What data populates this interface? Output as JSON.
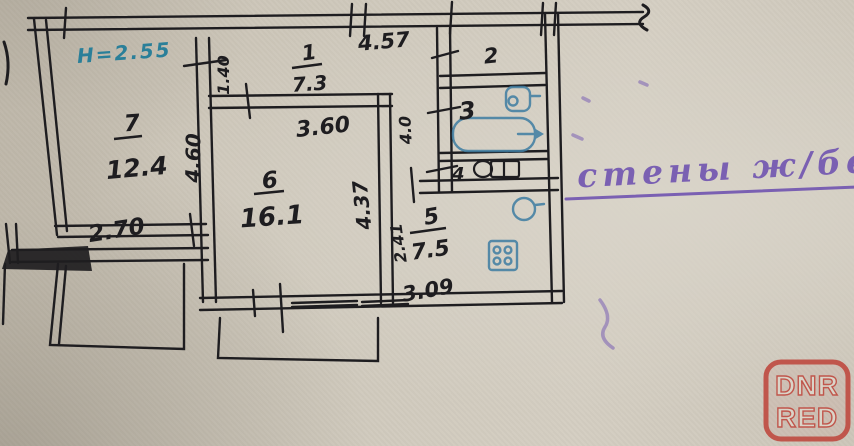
{
  "notes": {
    "ceiling_height": "Н=2.55",
    "wall_material": "стены ж/бет."
  },
  "rooms": {
    "r7": {
      "num": "7",
      "area": "12.4"
    },
    "r1": {
      "num": "1",
      "area": "7.3"
    },
    "r6": {
      "num": "6",
      "area": "16.1"
    },
    "r5": {
      "num": "5",
      "area": "7.5"
    },
    "r2": {
      "num": "2"
    },
    "r3": {
      "num": "3"
    },
    "r4": {
      "num": "4"
    }
  },
  "dims": {
    "top_wall": "4.57",
    "room7_width": "2.70",
    "room7_height": "4.60",
    "hall_height": "1.40",
    "room6_width": "3.60",
    "room6_height": "4.37",
    "corridor_length": "4.0",
    "kitchen_height": "2.41",
    "kitchen_width": "3.09"
  },
  "fixtures": {
    "bathtub": "bathtub",
    "bath_sink": "bath-sink",
    "kitchen_sink": "kitchen-sink",
    "stove": "stove",
    "toilet": "toilet"
  },
  "logo": {
    "line1": "DNR",
    "line2": "RED"
  },
  "colors": {
    "paper": "#cfc9bc",
    "ink": "#1e1d20",
    "fixture_blue": "#3e7da2",
    "note_teal": "#2a7f99",
    "note_purple": "#6e51b0",
    "logo_red": "#bf4a40",
    "logo_letters": "#dcd6ca"
  }
}
